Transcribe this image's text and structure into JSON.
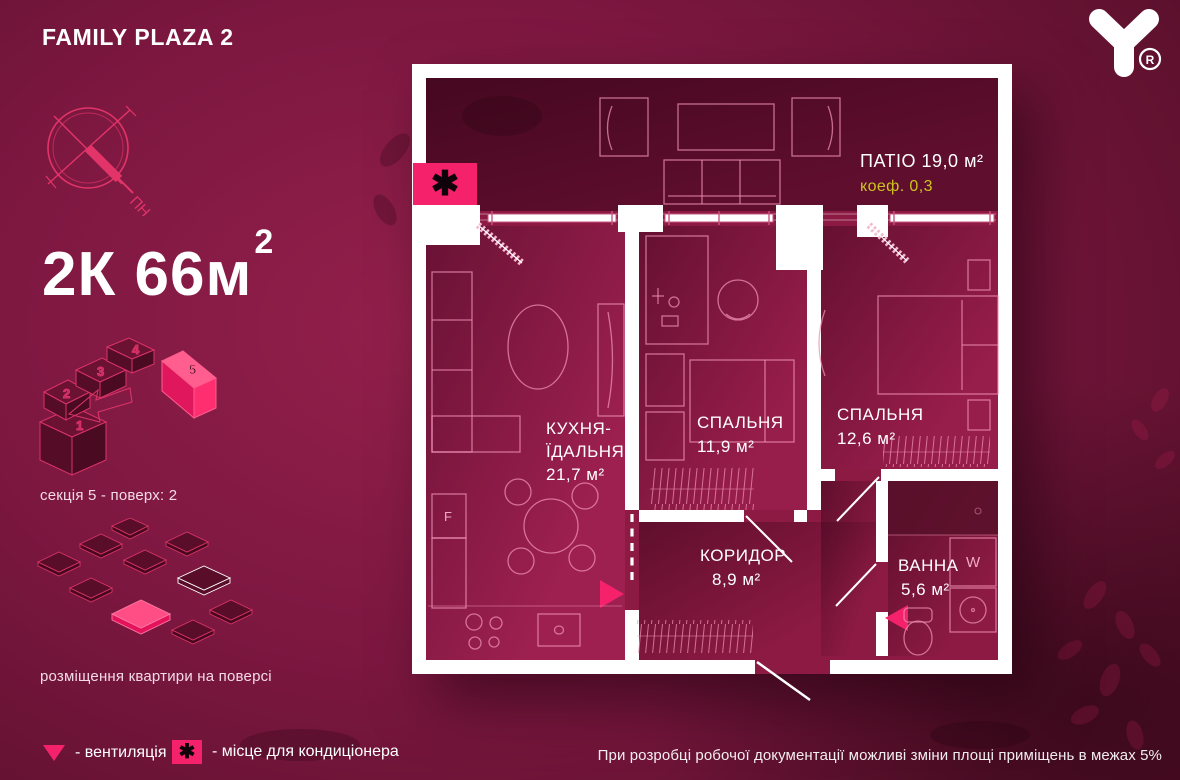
{
  "header": {
    "title": "FAMILY PLAZA 2"
  },
  "logo": {
    "registered": "R"
  },
  "compass": {
    "north_label": "ПН"
  },
  "apartment": {
    "headline_main": "2К 66м",
    "headline_sup": "2",
    "section_info": "секція 5 - поверх: 2",
    "placement_caption": "розміщення квартири на поверсі"
  },
  "building": {
    "sections": [
      "1",
      "2",
      "3",
      "4",
      "5"
    ],
    "highlighted_section": "5"
  },
  "floorplan": {
    "patio": {
      "label": "ПАТІО 19,0 м²",
      "coef": "коеф. 0,3"
    },
    "kitchen": {
      "line1": "КУХНЯ-",
      "line2": "ЇДАЛЬНЯ",
      "area": "21,7 м²"
    },
    "bedroom1": {
      "name": "СПАЛЬНЯ",
      "area": "11,9 м²"
    },
    "bedroom2": {
      "name": "СПАЛЬНЯ",
      "area": "12,6 м²"
    },
    "corridor": {
      "name": "КОРИДОР",
      "area": "8,9 м²"
    },
    "bathroom": {
      "name": "ВАННА",
      "area": "5,6 м²"
    },
    "markers": {
      "fridge": "F",
      "washer": "W",
      "ac": "✱"
    }
  },
  "legend": {
    "vent_label": "- вентиляція",
    "ac_label": "- місце для кондиціонера",
    "ac_symbol": "✱"
  },
  "disclaimer": "При розробці робочої документації можливі зміни площі приміщень в межах 5%",
  "colors": {
    "accent": "#f5226b",
    "background": "#5c102a",
    "coef_text": "#cdc51d",
    "room": "#9e2050",
    "patio": "#5f0e2d",
    "wall": "#ffffff"
  }
}
